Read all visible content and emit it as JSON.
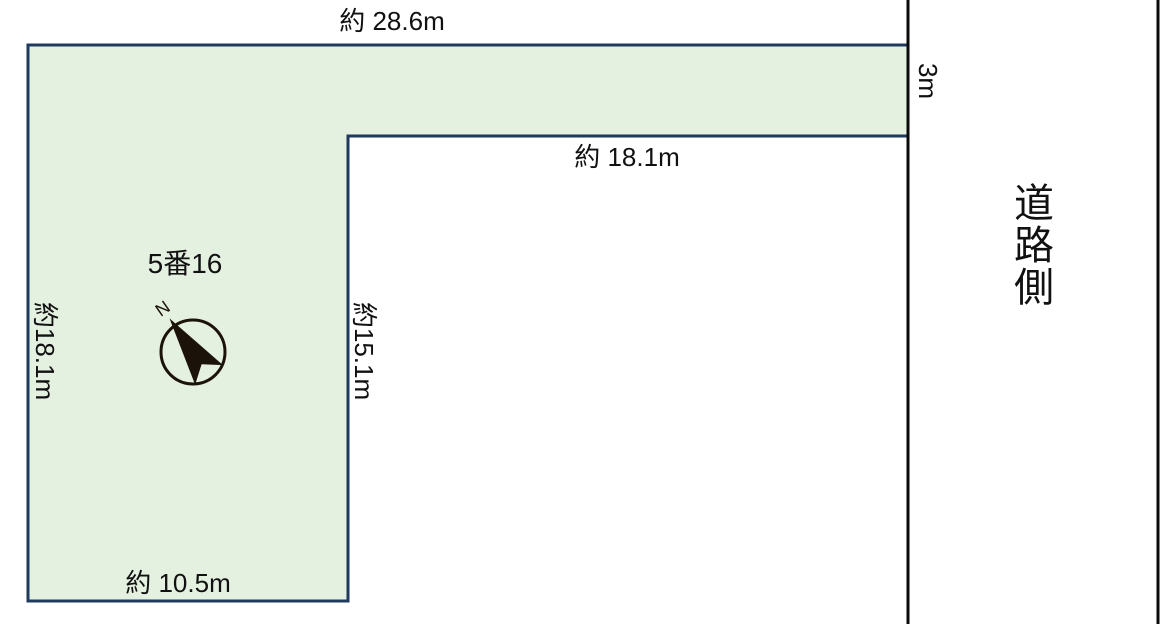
{
  "parcel": {
    "lot_number": "5番16",
    "dim_top": "約 28.6m",
    "dim_inner_horizontal": "約 18.1m",
    "dim_left": "約18.1m",
    "dim_inner_vertical": "約15.1m",
    "dim_bottom": "約 10.5m",
    "dim_strip_depth": "3m"
  },
  "road": {
    "side_label": "道路側"
  },
  "compass": {
    "north": "N"
  },
  "colors": {
    "parcel_fill": "#e4f0e0",
    "parcel_border": "#1f3a5c",
    "road_line": "#0a0a0a",
    "compass_ink": "#1b1209",
    "text": "#111111"
  }
}
